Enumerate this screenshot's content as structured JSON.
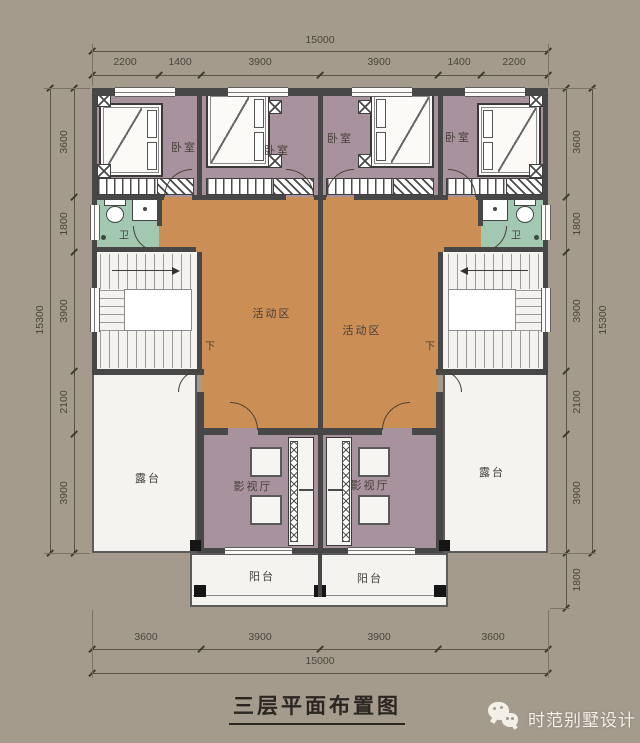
{
  "title": "三层平面布置图",
  "watermark": {
    "icon": "wechat-icon",
    "brand": "时范别墅设计"
  },
  "rooms": {
    "bedroom": "卧室",
    "bathroom": "卫",
    "activity": "活动区",
    "media": "影视厅",
    "terrace": "露台",
    "balcony": "阳台",
    "stairs_down": "下"
  },
  "dimensions": {
    "top": {
      "overall": "15000",
      "segments": [
        "2200",
        "1400",
        "3900",
        "3900",
        "1400",
        "2200"
      ]
    },
    "bottom": {
      "overall": "15000",
      "segments": [
        "3600",
        "3900",
        "3900",
        "3600"
      ]
    },
    "left": {
      "overall": "15300",
      "segments": [
        "3600",
        "1800",
        "3900",
        "2100",
        "3900"
      ]
    },
    "right": {
      "overall": "15300",
      "segments": [
        "3600",
        "1800",
        "3900",
        "2100",
        "3900"
      ],
      "balcony_depth": "1800"
    }
  },
  "colors": {
    "background": "#a49b8d",
    "bedroom_floor": "#a8929e",
    "activity_floor": "#cb8e55",
    "bathroom_floor": "#a2c8b2",
    "white_floor": "#f4f3ef",
    "wall": "#474747",
    "dim_text": "#4b463b",
    "title_text": "#2b2620",
    "watermark_text": "#f3f0e8"
  }
}
